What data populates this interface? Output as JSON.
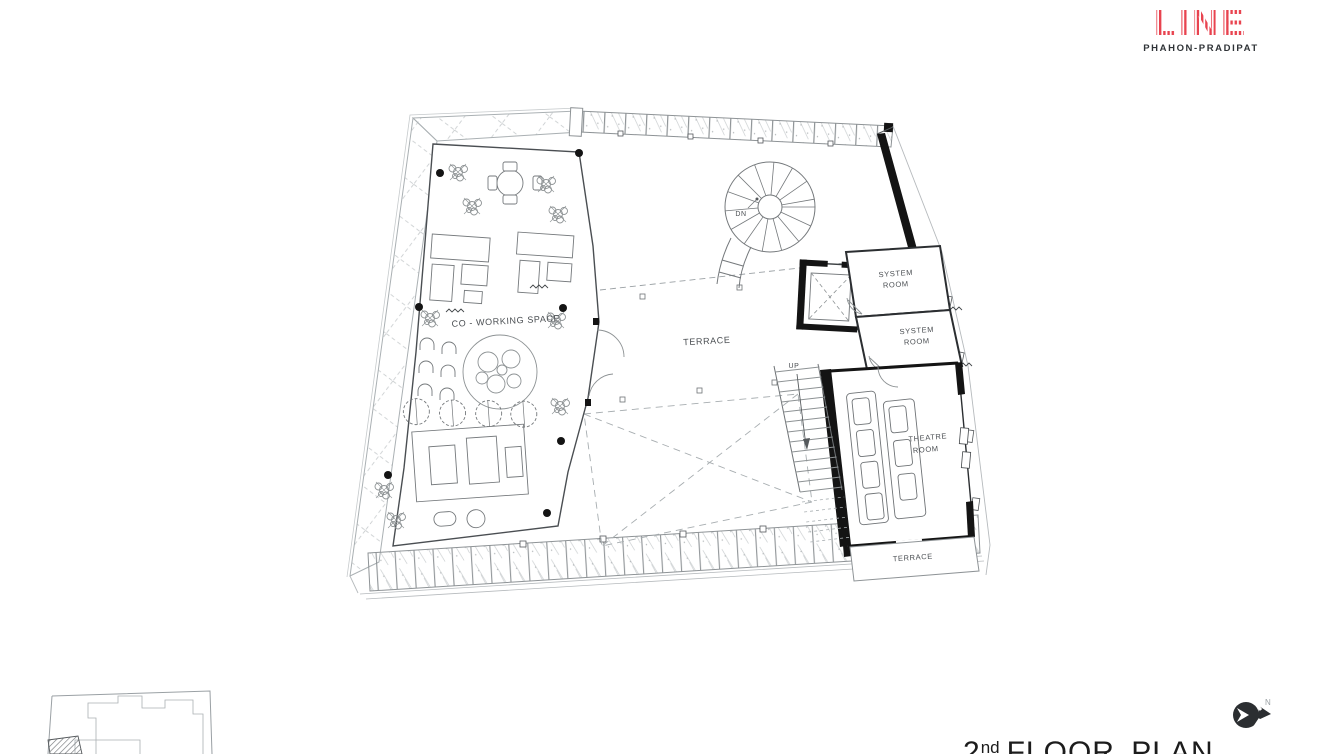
{
  "page": {
    "background": "#ffffff"
  },
  "logo": {
    "brand": "LINE",
    "subtitle": "PHAHON-PRADIPAT",
    "color": "#e8434f"
  },
  "plan_title": {
    "number": "2",
    "ordinal": "nd",
    "rest": "FLOOR PLAN"
  },
  "north": {
    "label": "N"
  },
  "plan_labels": {
    "coworking": "CO - WORKING SPACE",
    "terrace_main": "TERRACE",
    "system1_l1": "SYSTEM",
    "system1_l2": "ROOM",
    "system2_l1": "SYSTEM",
    "system2_l2": "ROOM",
    "theatre_l1": "THEATRE",
    "theatre_l2": "ROOM",
    "terrace_lower": "TERRACE",
    "down": "DN",
    "up": "UP"
  },
  "colors": {
    "logo_red": "#e8434f",
    "wall_black": "#141414",
    "line_dark": "#3c4043",
    "line_light": "#9aa0a4"
  }
}
